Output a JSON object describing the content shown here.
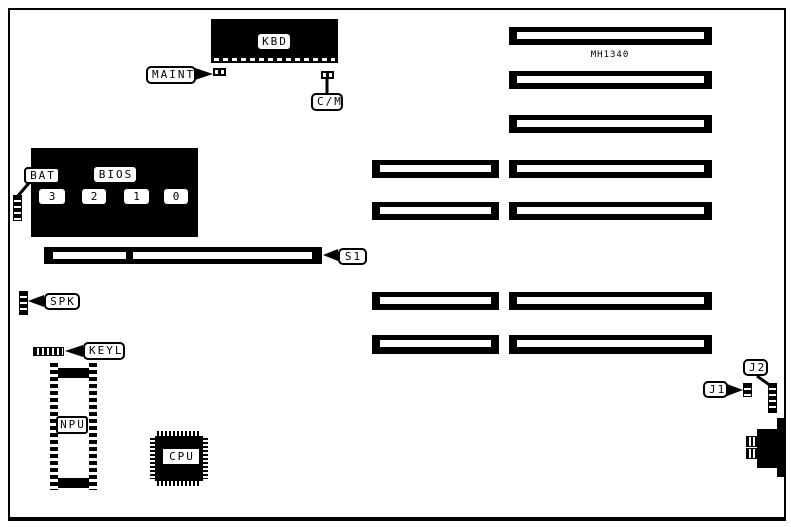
{
  "labels": {
    "kbd": "KBD",
    "maint": "MAINT",
    "cm": "C/M",
    "bat": "BAT",
    "bios": "BIOS",
    "s1": "S1",
    "spk": "SPK",
    "keyl": "KEYL",
    "npu": "NPU",
    "cpu": "CPU",
    "j1": "J1",
    "j2": "J2",
    "model": "MH1340"
  },
  "bios_chips": [
    "3",
    "2",
    "1",
    "0"
  ],
  "colors": {
    "ink": "#000000",
    "paper": "#ffffff"
  }
}
